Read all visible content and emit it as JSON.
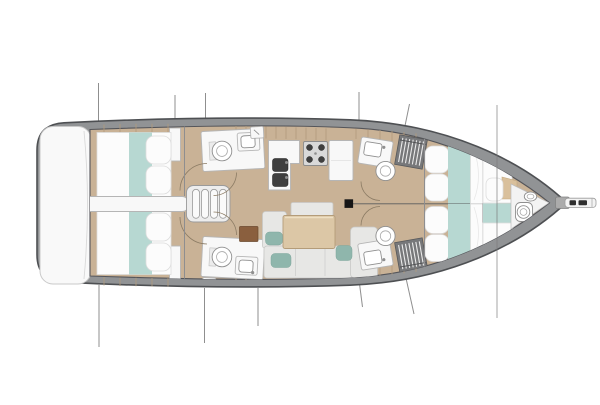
{
  "meta": {
    "title": "Sailing yacht interior layout — top-down deck plan, bow to the right",
    "figure_type": "boat floor plan",
    "orientation": "bow facing right"
  },
  "colors": {
    "page-bg": "#ffffff",
    "hull-outline": "#4e5053",
    "hull-rim": "#919395",
    "deck-white": "#f9f9f9",
    "floor-wood": "#c9b296",
    "wood-seam": "#b19a7c",
    "furniture-white": "#f8f8f8",
    "furniture-stroke": "#b5b5b5",
    "bedding-white": "#fcfcfc",
    "teal": "#b7d8d2",
    "teal-dark": "#8fb6ac",
    "sofa-gray": "#e7e7e5",
    "table-wood": "#dcc7a6",
    "cabinet-brown": "#8a5f3e",
    "dark-fixture": "#3f3f3f",
    "locker-gray": "#77787a",
    "stair-white": "#fafafa",
    "rig-line": "#8f8f8f",
    "mast-black": "#161616"
  },
  "rooms": [
    {
      "id": "swim-platform",
      "label": "stern swim platform"
    },
    {
      "id": "aft-cabin-port",
      "label": "aft double cabin (port)"
    },
    {
      "id": "aft-cabin-starboard",
      "label": "aft double cabin (starboard)"
    },
    {
      "id": "aft-head-port",
      "label": "aft head with shower (port)"
    },
    {
      "id": "aft-head-starboard",
      "label": "aft head with shower (starboard)"
    },
    {
      "id": "companionway",
      "label": "companionway steps"
    },
    {
      "id": "galley",
      "label": "L-shaped galley with stove, twin sinks and refrigerator"
    },
    {
      "id": "salon",
      "label": "salon with sofa and table"
    },
    {
      "id": "mast",
      "label": "mast step"
    },
    {
      "id": "forward-head-port",
      "label": "forward head (port)"
    },
    {
      "id": "forward-head-starboard",
      "label": "forward head (starboard)"
    },
    {
      "id": "forward-cabin-port",
      "label": "forward double cabin (port)"
    },
    {
      "id": "forward-cabin-starboard",
      "label": "forward double cabin (starboard)"
    },
    {
      "id": "bow-cabin",
      "label": "bow crew cabin"
    },
    {
      "id": "bow-head",
      "label": "bow head"
    },
    {
      "id": "bowsprit",
      "label": "bowsprit with anchor roller"
    }
  ]
}
